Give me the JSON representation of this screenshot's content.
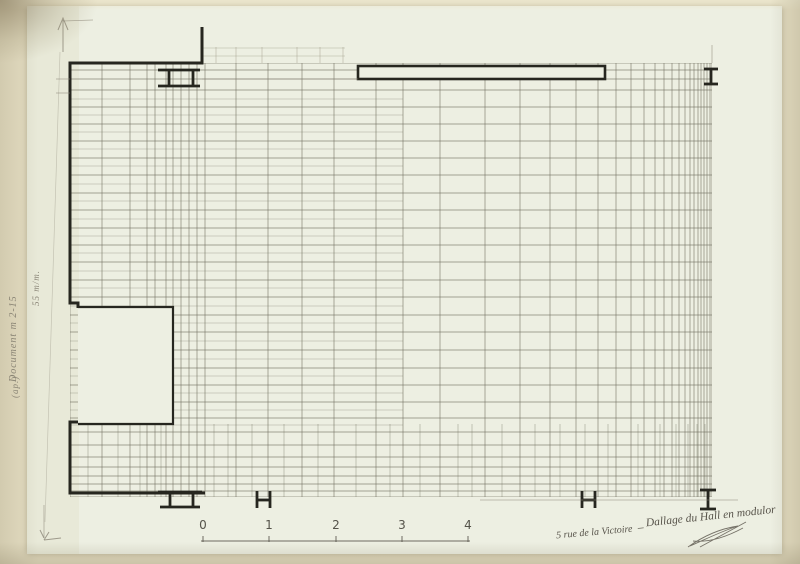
{
  "meta": {
    "subject": "Floor plan — tiling grid of a hall (modulor)"
  },
  "colors": {
    "mat": "#e6dfc4",
    "sheet": "#edefe2",
    "ink": "#26261f",
    "grid": "#6e6d5d",
    "grid_light": "#9b9883",
    "pencil": "#8b8678",
    "pencil_dark": "#57534a"
  },
  "annotations": {
    "side_note_1": "Document m 2-15",
    "side_note_2": "55 m/m.",
    "side_note_3": "(ap.)",
    "caption_left": "5 rue de la Victoire",
    "caption_right": "_ Dallage du Hall en modulor",
    "signature": "paraph"
  },
  "scale_bar": {
    "labels": [
      "0",
      "1",
      "2",
      "3",
      "4"
    ],
    "x_positions": [
      203,
      269,
      336,
      402,
      468
    ],
    "label_y": 518,
    "line_y": 541,
    "x_start": 201,
    "x_end": 470,
    "tick_height": 5
  },
  "drawing": {
    "grid_region": {
      "x1": 70,
      "y1": 63,
      "x2": 712,
      "y2": 497
    },
    "grid": {
      "v_full": [
        70,
        102,
        130,
        147,
        155,
        166,
        173,
        181,
        189,
        197,
        205,
        236,
        268,
        302,
        334,
        376,
        403,
        440,
        485,
        520,
        550,
        576,
        598,
        616,
        631,
        644,
        655,
        664,
        672,
        679,
        685,
        690,
        694,
        698,
        701,
        704,
        707,
        710,
        712
      ],
      "v_partial": [
        88,
        118,
        140,
        161,
        214,
        228,
        252,
        284,
        318,
        356,
        390,
        420,
        458,
        472,
        502,
        535,
        560,
        585,
        608,
        638,
        660,
        676,
        688,
        697,
        705
      ],
      "v_partial_y": [
        424,
        497
      ],
      "h_full": [
        63,
        70,
        79,
        90,
        107,
        124,
        141,
        158,
        175,
        193,
        210,
        228,
        245,
        262,
        280,
        297,
        315,
        332,
        350,
        368,
        385,
        402,
        418,
        432,
        445,
        457,
        467,
        476,
        484,
        491,
        497
      ],
      "h_partial": [
        99,
        115,
        132,
        149,
        166,
        184,
        201,
        219,
        236,
        253,
        271,
        288,
        306,
        323,
        341,
        359,
        376,
        393,
        410,
        425
      ],
      "h_partial_x": [
        70,
        403
      ],
      "top_patch_v": [
        202,
        216,
        236,
        262,
        297,
        320,
        343
      ],
      "top_patch_v_y": [
        47,
        63
      ],
      "top_patch_h": [
        48,
        56
      ],
      "top_patch_h_x": [
        202,
        345
      ]
    },
    "walls": [
      "M202,27 L202,63 L70,63 L70,303 L78,303 L78,308",
      "M78,422 L70,422 L70,493 L205,493"
    ],
    "block": {
      "x": 78,
      "y": 307,
      "w": 95,
      "h": 117
    },
    "beam": {
      "x": 358,
      "y": 66,
      "w": 247,
      "h": 13
    },
    "columns": [
      {
        "name": "column-top-left",
        "segs": [
          [
            158,
            70,
            200,
            70
          ],
          [
            158,
            86,
            200,
            86
          ],
          [
            169,
            70,
            169,
            86
          ],
          [
            193,
            70,
            193,
            86
          ]
        ]
      },
      {
        "name": "column-top-right",
        "segs": [
          [
            704,
            69,
            718,
            69
          ],
          [
            704,
            84,
            718,
            84
          ],
          [
            711,
            69,
            711,
            84
          ]
        ]
      },
      {
        "name": "column-bottom-left",
        "segs": [
          [
            158,
            492,
            202,
            492
          ],
          [
            160,
            507,
            200,
            507
          ],
          [
            170,
            492,
            170,
            507
          ],
          [
            193,
            492,
            193,
            507
          ]
        ]
      },
      {
        "name": "column-bottom-h1",
        "segs": [
          [
            257,
            491,
            257,
            508
          ],
          [
            270,
            491,
            270,
            508
          ],
          [
            257,
            500,
            270,
            500
          ]
        ]
      },
      {
        "name": "column-bottom-h2",
        "segs": [
          [
            582,
            491,
            582,
            508
          ],
          [
            595,
            491,
            595,
            508
          ],
          [
            582,
            500,
            595,
            500
          ]
        ]
      },
      {
        "name": "column-bottom-right",
        "segs": [
          [
            700,
            490,
            716,
            490
          ],
          [
            700,
            509,
            716,
            509
          ],
          [
            708,
            490,
            708,
            509
          ]
        ]
      }
    ],
    "pencil_lines": [
      [
        56,
        79,
        70,
        79
      ],
      [
        56,
        93,
        70,
        93
      ],
      [
        202,
        79,
        358,
        79
      ],
      [
        480,
        500,
        738,
        500
      ],
      [
        712,
        45,
        712,
        63
      ],
      [
        44,
        505,
        44,
        538
      ],
      [
        63,
        21,
        93,
        20
      ]
    ],
    "pencil_faint_vertical": [
      60,
      52,
      45,
      522
    ],
    "arrow_up": "M63,52 L63,20 M58,30 L63,18 L68,30",
    "arrow_down": "M44,538 L40,530 M44,540 L49,532 M44,540 L61,538",
    "signature_path": "M688,547 C702,537 718,529 738,526 C722,531 704,540 690,546 M700,547 L746,522 M693,541 C712,543 730,535 743,528"
  }
}
